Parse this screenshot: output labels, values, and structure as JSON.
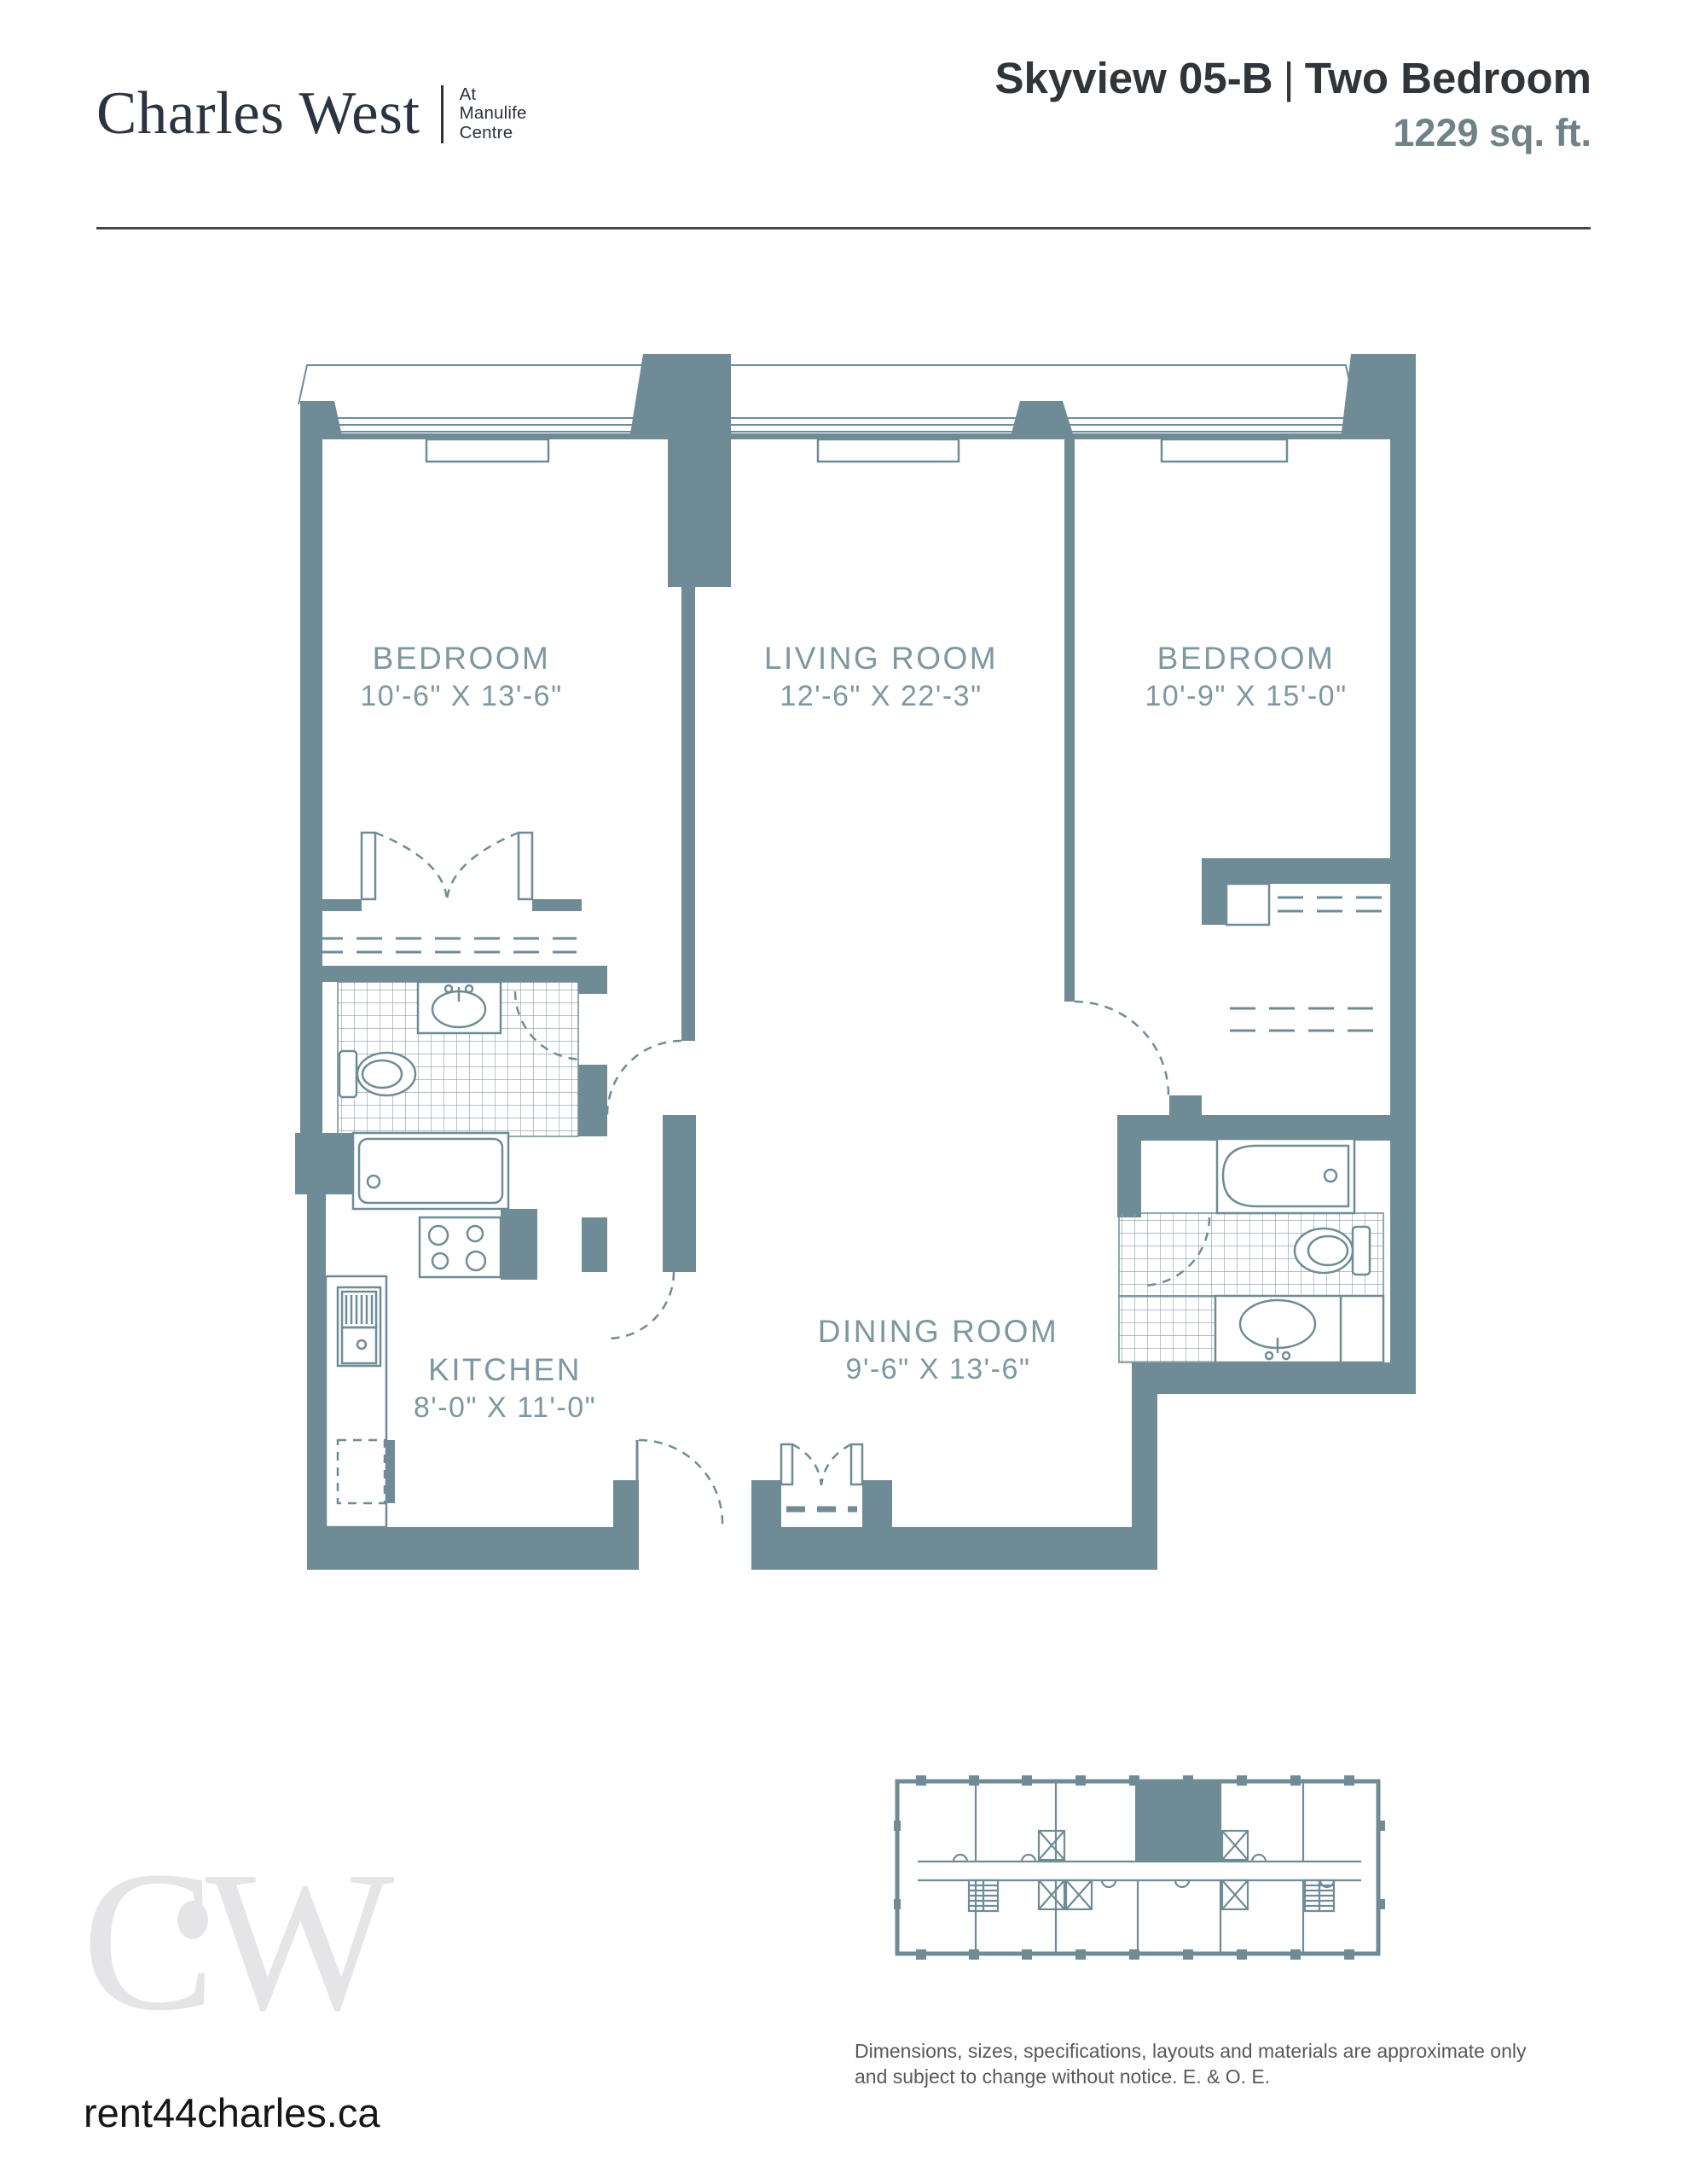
{
  "header": {
    "logo": {
      "brand": "Charles West",
      "tagline_line1": "At",
      "tagline_line2": "Manulife",
      "tagline_line3": "Centre"
    },
    "title": {
      "plan_name": "Skyview 05-B",
      "separator": "|",
      "plan_type": "Two Bedroom",
      "area": "1229 sq. ft."
    }
  },
  "plan": {
    "rooms": [
      {
        "name": "BEDROOM",
        "dims": "10'-6\" X 13'-6\""
      },
      {
        "name": "LIVING ROOM",
        "dims": "12'-6\" X 22'-3\""
      },
      {
        "name": "BEDROOM",
        "dims": "10'-9\" X 15'-0\""
      },
      {
        "name": "KITCHEN",
        "dims": "8'-0\" X 11'-0\""
      },
      {
        "name": "DINING ROOM",
        "dims": "9'-6\" X 13'-6\""
      }
    ]
  },
  "footer": {
    "monogram": "CW",
    "website": "rent44charles.ca",
    "disclaimer_line1": "Dimensions, sizes, specifications, layouts and materials are approximate only",
    "disclaimer_line2": "and subject to change without notice. E. & O. E."
  },
  "colors": {
    "wall": "#6F8C96",
    "plan_text": "#7D98A1",
    "tile": "#95ABB2",
    "title": "#303539",
    "area": "#6E8287",
    "logo": "#2A333F",
    "watermark": "#E5E5E7",
    "divider": "#454649",
    "disclaimer": "#58595B",
    "website": "#161616"
  }
}
